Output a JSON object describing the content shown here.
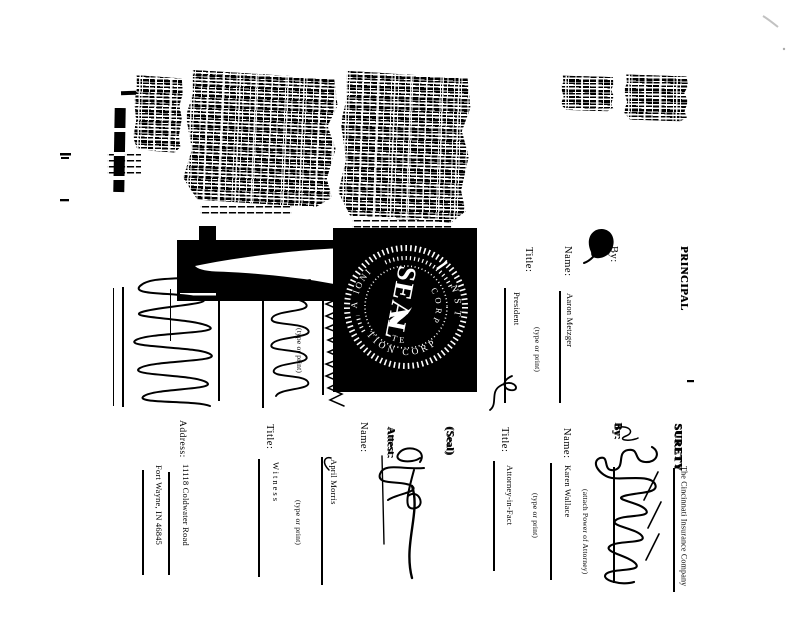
{
  "page": {
    "background": "#ffffff",
    "ink": "#000000"
  },
  "form": {
    "principal": {
      "header": "PRINCIPAL",
      "by_label": "By:",
      "name_label": "Name:",
      "name_value": "Aaron Metzger",
      "title_label": "Title:",
      "title_value": "President"
    },
    "surety": {
      "header": "SURETY",
      "company_name": "The Cincinnati Insurance Company",
      "by_label": "By:",
      "attach_note": "(attach Power of Attorney)",
      "name_label": "Name:",
      "name_value": "Karen Wallace",
      "title_label": "Title:",
      "title_value": "Attorney-in-Fact"
    },
    "witness": {
      "attest_label": "Attest:",
      "seal_note": "(Seal)",
      "name_label": "Name:",
      "name_value": "April Morris",
      "title_label": "Title:",
      "title_value": "Witness",
      "address_label": "Address:",
      "address_line1": "11118 Coldwater Road",
      "address_line2": "Fort Wayne, IN 46845"
    },
    "captions": {
      "type_or_print": "(type or print)"
    },
    "seal_stamp": {
      "center": "SEAL",
      "inner_right": "CORP",
      "inner_bottom": "TE",
      "arc_right": "NST",
      "arc_upper_left": "IONI",
      "arc_left": "A",
      "arc_bottom": "TION CORP"
    }
  }
}
